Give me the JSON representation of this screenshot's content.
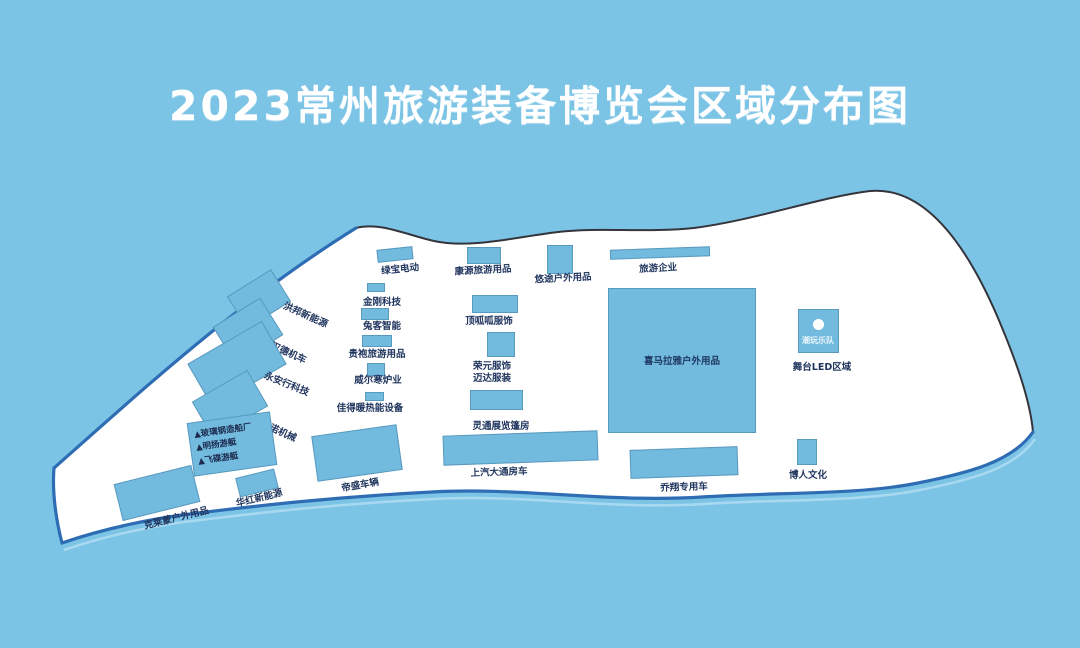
{
  "title": "2023常州旅游装备博览会区域分布图",
  "colors": {
    "background": "#7CC4E6",
    "land": "#FFFFFF",
    "outline": "#34353C",
    "coastline": "#2E6DB4",
    "booth_fill": "#72BBDE",
    "label_text": "#21365F",
    "title_text": "#FFFFFF"
  },
  "map": {
    "booths": [
      {
        "name": "hongbang-new-energy",
        "label": "洪邦新能源",
        "rect": {
          "cx": 259,
          "cy": 299,
          "w": 52,
          "h": 38,
          "rot": -32
        },
        "text": {
          "cx": 306,
          "cy": 314,
          "rot": 24
        }
      },
      {
        "name": "hande-motor",
        "label": "汉德机车",
        "rect": {
          "cx": 248,
          "cy": 331,
          "w": 56,
          "h": 44,
          "rot": -32
        },
        "text": {
          "cx": 289,
          "cy": 352,
          "rot": 24
        }
      },
      {
        "name": "yonganxing-tech",
        "label": "永安行科技",
        "rect": {
          "cx": 237,
          "cy": 364,
          "w": 86,
          "h": 50,
          "rot": -30
        },
        "text": {
          "cx": 287,
          "cy": 383,
          "rot": 22
        }
      },
      {
        "name": "kangnuo-machinery",
        "label": "康诺机械",
        "rect": {
          "cx": 230,
          "cy": 404,
          "w": 64,
          "h": 42,
          "rot": -30
        },
        "text": {
          "cx": 279,
          "cy": 430,
          "rot": 24
        }
      },
      {
        "name": "boat-makers",
        "rect": {
          "cx": 232,
          "cy": 444,
          "w": 84,
          "h": 54,
          "rot": -8
        },
        "lines": [
          "▲玻璃钢造船厂",
          "▲明扬游艇",
          "▲飞碟游艇"
        ]
      },
      {
        "name": "kelaimeng-outdoor",
        "label": "克莱蒙户外用品",
        "rect": {
          "cx": 157,
          "cy": 493,
          "w": 80,
          "h": 38,
          "rot": -14
        },
        "text": {
          "cx": 176,
          "cy": 517,
          "rot": -14
        }
      },
      {
        "name": "huahong-new-energy",
        "label": "华红新能源",
        "rect": {
          "cx": 257,
          "cy": 483,
          "w": 40,
          "h": 20,
          "rot": -14
        },
        "text": {
          "cx": 259,
          "cy": 497,
          "rot": -14
        }
      },
      {
        "name": "disheng-vehicles",
        "label": "帝盛车辆",
        "rect": {
          "cx": 357,
          "cy": 453,
          "w": 86,
          "h": 46,
          "rot": -8
        },
        "text": {
          "cx": 360,
          "cy": 484,
          "rot": -10
        }
      },
      {
        "name": "lvbao-electric",
        "label": "绿宝电动",
        "rect": {
          "cx": 395,
          "cy": 254,
          "w": 36,
          "h": 13,
          "rot": -6
        },
        "text": {
          "cx": 400,
          "cy": 268,
          "rot": -6
        }
      },
      {
        "name": "kangyuan-travel-goods",
        "label": "康源旅游用品",
        "rect": {
          "cx": 484,
          "cy": 255,
          "w": 34,
          "h": 17,
          "rot": 0
        },
        "text": {
          "cx": 483,
          "cy": 269,
          "rot": -3
        }
      },
      {
        "name": "youtu-outdoor",
        "label": "悠途户外用品",
        "rect": {
          "cx": 560,
          "cy": 259,
          "w": 26,
          "h": 29,
          "rot": 0
        },
        "text": {
          "cx": 563,
          "cy": 277,
          "rot": -3
        }
      },
      {
        "name": "tourism-enterprises",
        "label": "旅游企业",
        "rect": {
          "cx": 660,
          "cy": 253,
          "w": 100,
          "h": 10,
          "rot": -2
        },
        "text": {
          "cx": 658,
          "cy": 267,
          "rot": -3
        }
      },
      {
        "name": "jingang-tech",
        "label": "金刚科技",
        "rect": {
          "cx": 376,
          "cy": 287,
          "w": 18,
          "h": 9,
          "rot": 0
        },
        "text": {
          "cx": 382,
          "cy": 301,
          "rot": 0
        }
      },
      {
        "name": "tuke-smart",
        "label": "兔客智能",
        "rect": {
          "cx": 375,
          "cy": 314,
          "w": 28,
          "h": 12,
          "rot": 0
        },
        "text": {
          "cx": 382,
          "cy": 325,
          "rot": 0
        }
      },
      {
        "name": "guipao-travel-goods",
        "label": "贵袍旅游用品",
        "rect": {
          "cx": 377,
          "cy": 341,
          "w": 30,
          "h": 12,
          "rot": 0
        },
        "text": {
          "cx": 377,
          "cy": 353,
          "rot": 0
        }
      },
      {
        "name": "weierhan-stoves",
        "label": "威尔寒炉业",
        "rect": {
          "cx": 376,
          "cy": 369,
          "w": 18,
          "h": 13,
          "rot": 0
        },
        "text": {
          "cx": 378,
          "cy": 379,
          "rot": 0
        }
      },
      {
        "name": "jiadenuan-thermal",
        "label": "佳得暖热能设备",
        "rect": {
          "cx": 374,
          "cy": 396,
          "w": 19,
          "h": 9,
          "rot": 0
        },
        "text": {
          "cx": 370,
          "cy": 407,
          "rot": 0
        }
      },
      {
        "name": "dingguagua-apparel",
        "label": "顶呱呱服饰",
        "rect": {
          "cx": 495,
          "cy": 304,
          "w": 46,
          "h": 18,
          "rot": 0
        },
        "text": {
          "cx": 489,
          "cy": 320,
          "rot": 0
        }
      },
      {
        "name": "rongyuan-maida",
        "rect": {
          "cx": 501,
          "cy": 344,
          "w": 28,
          "h": 25,
          "rot": 0
        },
        "label_lines": [
          "荣元服饰",
          "迈达服装"
        ],
        "text": {
          "cx": 492,
          "cy": 365,
          "rot": 0
        }
      },
      {
        "name": "lingtong-tents",
        "label": "灵通展览篷房",
        "rect": {
          "cx": 496,
          "cy": 400,
          "w": 53,
          "h": 20,
          "rot": 0
        },
        "text": {
          "cx": 501,
          "cy": 425,
          "rot": 0
        }
      },
      {
        "name": "saic-maxus-rv",
        "label": "上汽大通房车",
        "rect": {
          "cx": 520,
          "cy": 448,
          "w": 155,
          "h": 30,
          "rot": -2
        },
        "text": {
          "cx": 499,
          "cy": 471,
          "rot": -2
        }
      },
      {
        "name": "ximalaya-outdoor",
        "rect": {
          "cx": 682,
          "cy": 360,
          "w": 148,
          "h": 145,
          "rot": 0
        },
        "inner_label": "喜马拉雅户外用品"
      },
      {
        "name": "qiaoxiang-vehicles",
        "label": "乔翔专用车",
        "rect": {
          "cx": 684,
          "cy": 462,
          "w": 108,
          "h": 29,
          "rot": -2
        },
        "text": {
          "cx": 684,
          "cy": 486,
          "rot": -2
        }
      },
      {
        "name": "boren-culture",
        "label": "博人文化",
        "rect": {
          "cx": 807,
          "cy": 452,
          "w": 20,
          "h": 26,
          "rot": 0
        },
        "text": {
          "cx": 808,
          "cy": 474,
          "rot": 0
        }
      },
      {
        "name": "stage-led",
        "rect": {
          "cx": 818,
          "cy": 331,
          "w": 41,
          "h": 44,
          "rot": 0
        },
        "circle": true,
        "inner_label": "潮玩乐队",
        "inner_light": true,
        "caption": "舞台LED区域",
        "caption_pos": {
          "cx": 822,
          "cy": 366
        }
      }
    ]
  }
}
